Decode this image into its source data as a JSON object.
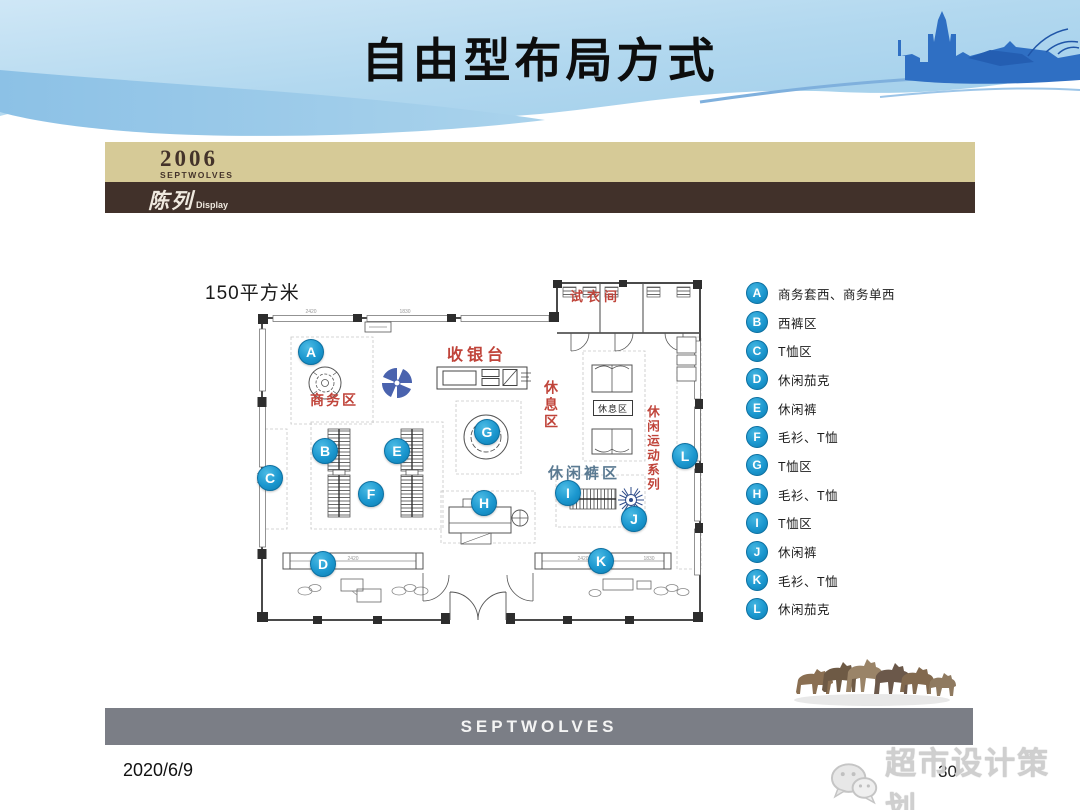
{
  "slide": {
    "title": "自由型布局方式",
    "date": "2020/6/9",
    "page_number": "30",
    "watermark_text": "超市设计策划"
  },
  "brand_bar": {
    "year": "2006",
    "brand": "SEPTWOLVES",
    "section_cn": "陈列",
    "section_en": "Display"
  },
  "footer": {
    "logo": "SEPTWOLVES"
  },
  "floor_plan": {
    "area_label": "150平方米",
    "zone_labels": {
      "cashier": "收银台",
      "business": "商务区",
      "fitting_room": "试衣间",
      "rest_vertical": "休息区",
      "rest_box": "休息区",
      "casual_pants": "休闲裤区",
      "casual_sports": "休闲运动系列"
    },
    "dimension_labels": {
      "d1": "2420",
      "d2": "1830"
    },
    "markers": [
      {
        "id": "A",
        "x": 57,
        "y": 72
      },
      {
        "id": "B",
        "x": 71,
        "y": 171
      },
      {
        "id": "C",
        "x": 16,
        "y": 198
      },
      {
        "id": "D",
        "x": 69,
        "y": 284
      },
      {
        "id": "E",
        "x": 143,
        "y": 171
      },
      {
        "id": "F",
        "x": 117,
        "y": 214
      },
      {
        "id": "G",
        "x": 233,
        "y": 152
      },
      {
        "id": "H",
        "x": 230,
        "y": 223
      },
      {
        "id": "I",
        "x": 314,
        "y": 213
      },
      {
        "id": "J",
        "x": 380,
        "y": 239
      },
      {
        "id": "K",
        "x": 347,
        "y": 281
      },
      {
        "id": "L",
        "x": 431,
        "y": 176
      }
    ]
  },
  "legend": {
    "items": [
      {
        "key": "A",
        "label": "商务套西、商务单西"
      },
      {
        "key": "B",
        "label": "西裤区"
      },
      {
        "key": "C",
        "label": "T恤区"
      },
      {
        "key": "D",
        "label": "休闲茄克"
      },
      {
        "key": "E",
        "label": "休闲裤"
      },
      {
        "key": "F",
        "label": "毛衫、T恤"
      },
      {
        "key": "G",
        "label": "T恤区"
      },
      {
        "key": "H",
        "label": "毛衫、T恤"
      },
      {
        "key": "I",
        "label": "T恤区"
      },
      {
        "key": "J",
        "label": "休闲裤"
      },
      {
        "key": "K",
        "label": "毛衫、T恤"
      },
      {
        "key": "L",
        "label": "休闲茄克"
      }
    ]
  },
  "colors": {
    "marker_blue": "#1b9ad2",
    "zone_red": "#c0443a",
    "pants_label_blue": "#5a7a92",
    "tan_band": "#d6ca97",
    "brown_band": "#41312a",
    "footer_gray": "#7b7e86",
    "header_blue": "#aed5ee",
    "castle_blue": "#2f6fc3"
  }
}
